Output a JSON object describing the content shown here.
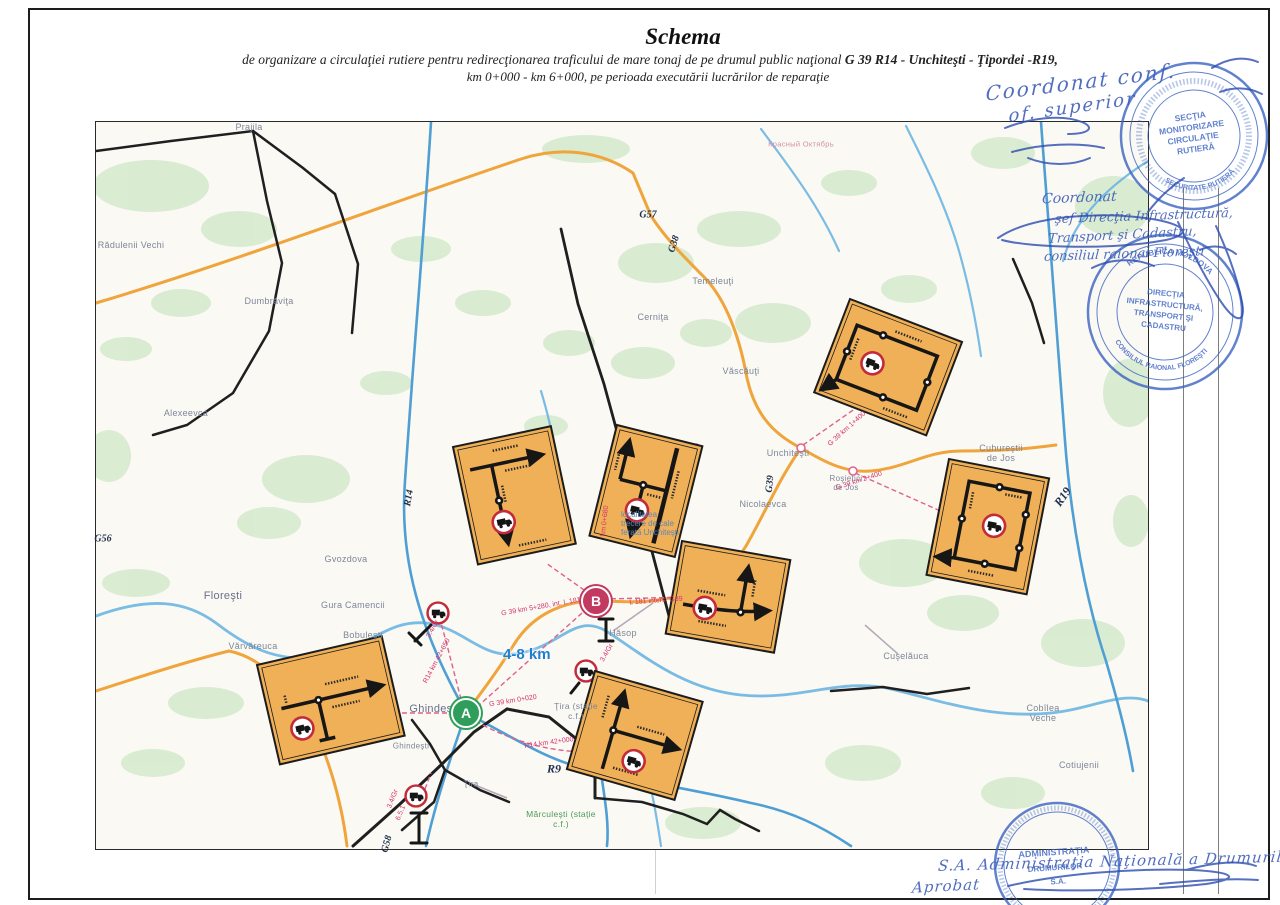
{
  "header": {
    "title": "Schema",
    "subtitle_normal": "de organizare a circulaţiei rutiere pentru redirecţionarea traficului de mare tonaj de pe drumul  public naţional ",
    "subtitle_bold": "G 39  R14 - Unchiteşti - Ţipordei -R19,",
    "subtitle_line2": "km 0+000 - km 6+000, pe perioada executării lucrărilor de reparaţie"
  },
  "handwriting": {
    "coord1_l1": "Coordonat conf.",
    "coord1_l2": "of. superior",
    "coord2_l1": "Coordonat",
    "coord2_l2": "şef Direcţia Infrastructură,",
    "coord2_l3": "Transport şi Cadastru,",
    "coord2_l4": "consiliul raional Floreşti",
    "bottom_l1": "S.A.  Administraţia Naţională a Drumurilor.",
    "bottom_l2": "Aprobat"
  },
  "stamps": {
    "s1": {
      "center": [
        "SECŢIA",
        "MONITORIZARE",
        "CIRCULAŢIE",
        "RUTIERĂ"
      ],
      "ring_bottom": "SECURITATE RUTIERĂ",
      "color": "#3a63c2"
    },
    "s2": {
      "center": [
        "DIRECŢIA",
        "INFRASTRUCTURĂ,",
        "TRANSPORT ŞI",
        "CADASTRU"
      ],
      "ring_top": "REPUBLICA MOLDOVA",
      "ring_bottom": "CONSILIUL RAIONAL FLOREŞTI",
      "color": "#3a63c2"
    },
    "s3": {
      "center": [
        "ADMINISTRAŢIA",
        "DRUMURILOR",
        "S.A."
      ],
      "color": "#3a63c2"
    }
  },
  "map": {
    "distance_label": "4-8 km",
    "marker_a": "A",
    "marker_b": "B",
    "note": "localitatea\ntrecere de cale\nferată Unchiteşti",
    "road_labels": {
      "r14": "R14",
      "g56": "G56",
      "g57": "G57",
      "g38": "G38",
      "g39": "G39",
      "r19": "R19",
      "r9": "R9",
      "g58": "G58"
    },
    "towns": [
      "Prajila",
      "Rădulenii Vechi",
      "Dumbrăviţa",
      "Alexeevca",
      "Gvozdova",
      "Floreşti",
      "Gura Camencii",
      "Bobuleşti",
      "Vărvăreuca",
      "Ghindeşti",
      "Ghindeşti",
      "Ţira",
      "Ţira (staţie\nc.f.)",
      "Hăsop",
      "Unchiteşti",
      "Nicolaevca",
      "Roşietici\nde Jos",
      "Cuhureştii\nde Jos",
      "Văscăuţi",
      "Temeleuţi",
      "Cerniţa",
      "Cuşelăuca",
      "Cobîlea\nVeche",
      "Cotiujenii",
      "Mărculeşti (staţie\nc.f.)",
      "Красный Октябрь"
    ],
    "km_labels": [
      "G 39 km 0+020",
      "R14 km 42+000",
      "R14 km 42+650",
      "G 39 km 5+280, int. L 181",
      "L 181 inters. G39",
      "G 39 km 2+400",
      "G 39 km 1+400",
      "km 0+680",
      "3.4/Gr",
      "3.4/Gr",
      "3.4/Gr",
      "6.5.1"
    ],
    "colors": {
      "panel": "#f0b057",
      "prohibit_ring": "#c42b3a",
      "road_orange": "#f0a43c",
      "road_blue": "#4f9fd4",
      "river": "#6cb5e2",
      "rail_black": "#1f1f1f",
      "dash_pink": "#e0608a",
      "marker_a": "#2f9e5b",
      "marker_b": "#c23a60",
      "label_pink": "#d6336c",
      "town_gray": "#7d8698",
      "distance_blue": "#1f7fd0"
    }
  }
}
